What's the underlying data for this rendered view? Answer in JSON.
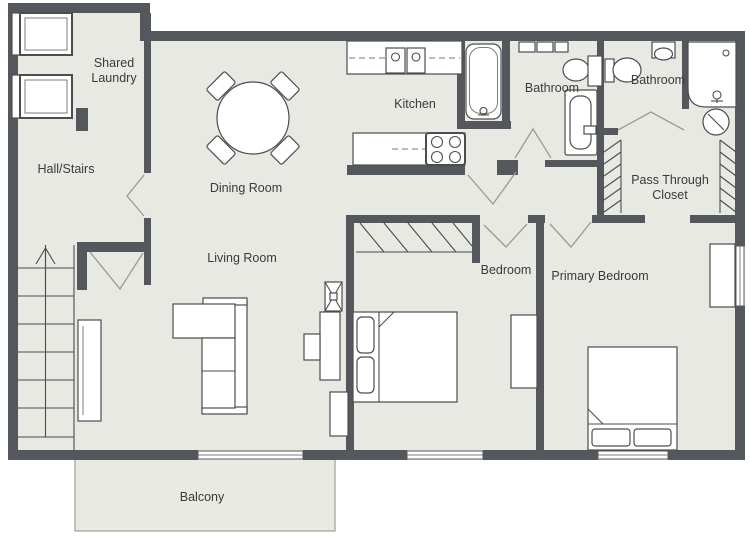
{
  "title": "Apartment Floor Plan",
  "colors": {
    "wall": "#54585c",
    "floor": "#e8e9e3",
    "balcony_floor": "#e9eae2",
    "fixture_stroke": "#4d4d4d",
    "label_text": "#3a3a3a",
    "background": "#ffffff"
  },
  "rooms": {
    "laundry": {
      "label": "Shared Laundry",
      "line1": "Shared",
      "line2": "Laundry"
    },
    "hall": {
      "label": "Hall/Stairs"
    },
    "dining": {
      "label": "Dining Room"
    },
    "kitchen": {
      "label": "Kitchen"
    },
    "bath1": {
      "label": "Bathroom"
    },
    "bath2": {
      "label": "Bathroom"
    },
    "closet": {
      "label": "Pass Through Closet",
      "line1": "Pass Through",
      "line2": "Closet"
    },
    "living": {
      "label": "Living Room"
    },
    "bedroom": {
      "label": "Bedroom"
    },
    "primary": {
      "label": "Primary Bedroom"
    },
    "balcony": {
      "label": "Balcony"
    }
  },
  "fixtures": [
    "washer-icon",
    "dryer-icon",
    "staircase-up-arrow-icon",
    "dining-table-icon",
    "dining-chair-icon",
    "kitchen-counter-icon",
    "kitchen-sink-icon",
    "stove-icon",
    "bathtub-icon",
    "towel-rack-icon",
    "vanity-sink-icon",
    "toilet-icon",
    "wash-basin-icon",
    "shower-icon",
    "laundry-hamper-icon",
    "closet-rail-icon",
    "sofa-icon",
    "tv-icon",
    "tv-console-icon",
    "media-unit-icon",
    "bookcase-icon",
    "console-table-icon",
    "double-bed-icon",
    "pillow-icon",
    "dresser-icon",
    "wardrobe-icon",
    "window-icon",
    "door-swing-icon"
  ]
}
